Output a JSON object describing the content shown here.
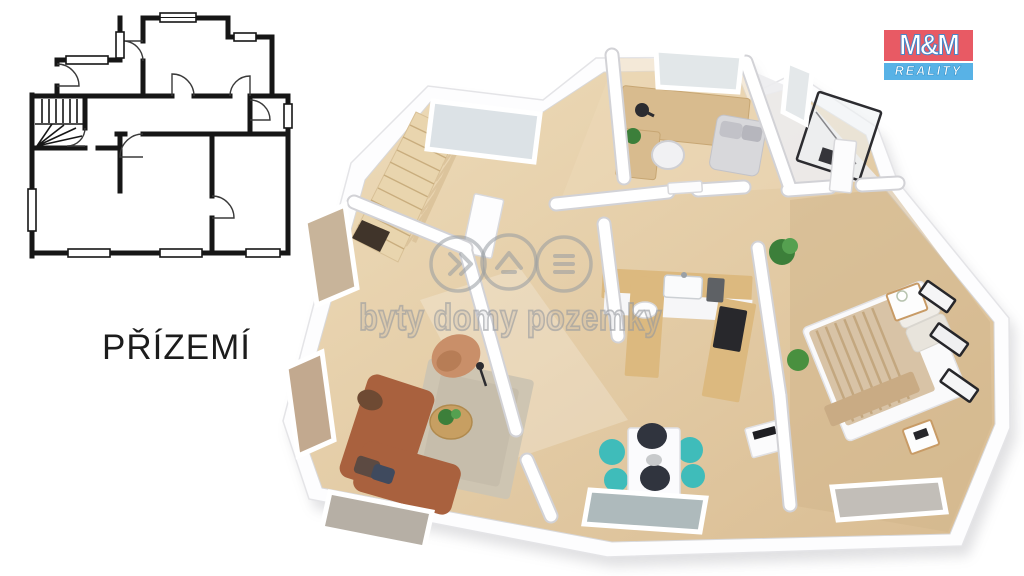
{
  "floor_label": {
    "text": "PŘÍZEMÍ"
  },
  "logo": {
    "line1": "M&M",
    "line2": "REALITY",
    "bg_top": "#e85a64",
    "bg_bottom": "#58b2e6"
  },
  "watermark": {
    "text": "byty domy pozemky",
    "icon1": "double-chevron-icon",
    "icon2": "house-roof-icon",
    "icon3": "layers-icon",
    "color": "#969ba0"
  },
  "palette": {
    "plan_line": "#161616",
    "wood_floor_light": "#ecd9b6",
    "wood_floor_dark": "#d9bc92",
    "wood_counter": "#dcb97f",
    "stairs_wood": "#e9d5ae",
    "sofa_brown": "#a9613e",
    "armchair_tan": "#c98f69",
    "rug_beige": "#cec5b2",
    "chair_teal": "#3fbcba",
    "chair_navy": "#30343e",
    "bed_blanket": "#d8c3a6",
    "plant_green": "#3c7f3a",
    "glass_gray": "#dce2e6",
    "wall_white": "#ffffff",
    "wall_shadow": "#d2d2d6"
  }
}
